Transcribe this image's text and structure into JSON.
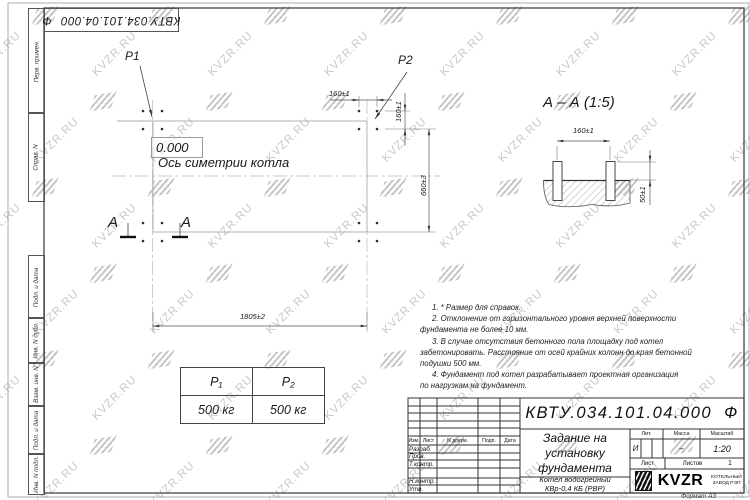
{
  "doc": {
    "number": "КВТУ.034.101.04.000",
    "suffix": "Ф"
  },
  "watermark": {
    "text": "KVZR.RU"
  },
  "margin_labels": {
    "perv": "Перв. примен.",
    "sprav": "Справ. N",
    "podp_data_1": "Подп. и дата",
    "inv_dubl": "Инв. N дубл.",
    "vzam_inv": "Взам. инв. N",
    "podp_data_2": "Подп. и дата",
    "inv_podl": "Инв. N подл."
  },
  "plan": {
    "p1": "P1",
    "p2": "P2",
    "elevation": "0.000",
    "axis_label": "Ось симетрии котла",
    "dim_bolt_h": "160±1",
    "dim_bolt_v": "160±1",
    "dim_width": "660±3",
    "dim_length": "1805±2",
    "section_letter": "A"
  },
  "section": {
    "title": "А – А (1:5)",
    "dim_span": "160±1",
    "dim_height": "50±1"
  },
  "notes": {
    "lines": [
      "1. * Размер для справок.",
      "2. Отклонение от горизонтального уровня верхней поверхности",
      "фундамента не более 10 мм.",
      "3. В случае отсутствия бетонного пола площадку под котел",
      "забетонировать. Расстояние от осей крайних колонн до края бетонной",
      "подушки 500 мм.",
      "4. Фундамент под котел разрабатывает проектная организация",
      "по нагрузкам на фундамент."
    ]
  },
  "load_table": {
    "col1": "P₁",
    "col2": "P₂",
    "val1": "500 кг",
    "val2": "500 кг"
  },
  "title_block": {
    "title_lines": [
      "Задание на",
      "установку",
      "фундамента"
    ],
    "product_lines": [
      "Котел водогрейный",
      "КВр-0,4  КБ  (РВР)"
    ],
    "lit_label": "Лит.",
    "mass_label": "Масса",
    "scale_label": "Масштаб",
    "lit": "И",
    "mass": "–",
    "scale": "1:20",
    "sheet_label": "Лист",
    "sheets_label": "Листов",
    "sheets_value": "1",
    "cols": {
      "izm": "Изм.",
      "list": "Лист",
      "doc": "N докум.",
      "podp": "Подп.",
      "data": "Дата"
    },
    "rows": {
      "razrab": "Разраб.",
      "prov": "Пров.",
      "tkontr": "Т.контр.",
      "nkontr": "Н.контр.",
      "utv": "Утв."
    },
    "logo_text": "KVZR",
    "logo_caption_lines": [
      "КОТЕЛЬНЫЙ",
      "ЗАВОД РЭП"
    ],
    "format": "Формат А3"
  }
}
